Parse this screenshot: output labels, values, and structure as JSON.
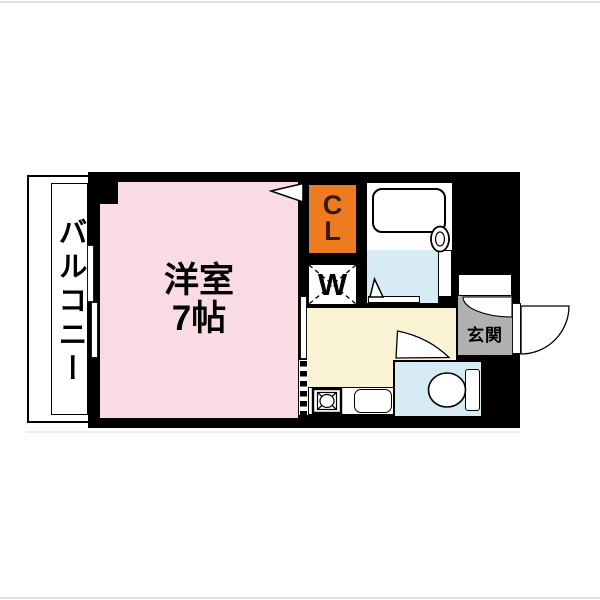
{
  "document": {
    "type": "apartment-floor-plan",
    "layout_label": "1K"
  },
  "floorplan": {
    "balcony": {
      "label": "バルコニー"
    },
    "main_room": {
      "name_label": "洋室",
      "size_label": "7帖"
    },
    "closet": {
      "letter_top": "C",
      "letter_bottom": "L"
    },
    "washer": {
      "label": "W"
    },
    "entrance": {
      "label": "玄関"
    },
    "fixtures": [
      "bathtub",
      "washer-space",
      "stove",
      "kitchen-sink",
      "toilet",
      "shoe-cabinet"
    ],
    "colors": {
      "wall_black": "#000000",
      "room_pink": "#f9dbe4",
      "closet_orange": "#ef7b21",
      "water_blue": "#d7ebf5",
      "kitchen_yellow": "#fbf4d4",
      "entrance_gray": "#b0b0b0",
      "paper_white": "#ffffff",
      "frame_gray": "#e3e3e3"
    }
  }
}
